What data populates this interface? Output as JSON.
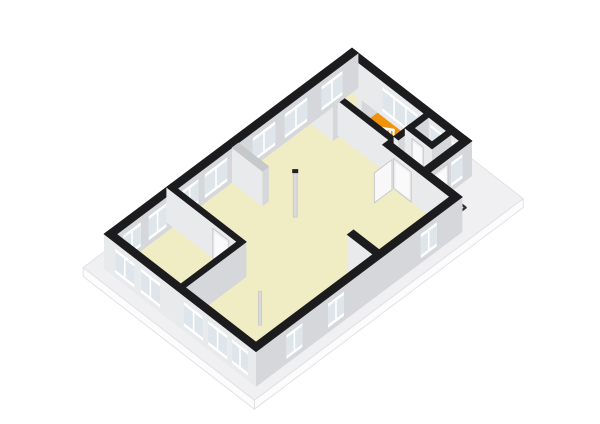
{
  "scene": {
    "description": "3d-isometric-floor-plan",
    "canvas": {
      "w": 600,
      "h": 424,
      "bg": "#ffffff"
    },
    "projection": {
      "origin": [
        352,
        83
      ],
      "axis_x": [
        0.8,
        0.62
      ],
      "axis_y": [
        -0.8,
        0.6
      ],
      "wall_height": 35,
      "slab_thickness": 9
    },
    "palette": {
      "bg": "#ffffff",
      "slab_top": "#f0f0f2",
      "slab_side": "#fcfcfd",
      "slab_edge": "#e2e2e6",
      "floor_cream": "#f0ecc3",
      "floor_orange": "#f0930c",
      "floor_white": "#fbfbfc",
      "wall_top_black": "#1c1c1e",
      "wall_top_gray": "#c7c8ca",
      "face_px": "#d5d7da",
      "face_py": "#e9eaec",
      "face_ny": "#f3f3f4",
      "face_nx": "#f6f6f7",
      "glass": "#dee6eb",
      "frame": "#ffffff",
      "door_frame": "#f1f1f2",
      "door_panel": "#fafafa",
      "door_edge": "#c9c9cc",
      "column": "#d8dadc",
      "column_cap": "#222226",
      "railing": "#ffffff",
      "stair_base": "#f4f4f5",
      "tread": "#cfcfcf",
      "arrow": "#ffffff",
      "arrow_edge": "#b5b5b8",
      "pad_border": "#323234",
      "pad_fill": "#ededef",
      "pad_inner": "#f7f7f8",
      "wc_top": "#fdfdfe",
      "wc_side": "#d9dbdd"
    },
    "slab": {
      "rect": [
        -14,
        -14,
        200,
        322
      ]
    },
    "floors": [
      {
        "id": "floor-living-room",
        "poly": [
          [
            8,
            8
          ],
          [
            142,
            8
          ],
          [
            142,
            52
          ],
          [
            182,
            52
          ],
          [
            182,
            302
          ],
          [
            8,
            302
          ]
        ],
        "color": "cream"
      },
      {
        "id": "floor-stairwell",
        "rect": [
          36,
          8,
          98,
          46
        ],
        "color": "orange"
      },
      {
        "id": "floor-toilet",
        "rect": [
          104,
          8,
          126,
          26
        ],
        "color": "white"
      },
      {
        "id": "floor-closet",
        "rect": [
          132,
          8,
          142,
          26
        ],
        "color": "white"
      },
      {
        "id": "floor-entrance-hall",
        "rect": [
          104,
          32,
          142,
          52
        ],
        "color": "white"
      }
    ],
    "stairs": {
      "strip": [
        48,
        22,
        96,
        44
      ],
      "treads": 10,
      "arrow": [
        [
          93,
          30.5
        ],
        [
          67,
          30.5
        ],
        [
          67,
          25.5
        ],
        [
          56,
          33
        ],
        [
          67,
          40.5
        ],
        [
          67,
          35.5
        ],
        [
          93,
          35.5
        ]
      ]
    },
    "railing": {
      "x1": 50,
      "x2": 96,
      "y": 44,
      "rise": [
        3,
        26
      ],
      "posts": 11,
      "post_h": 13,
      "z": 118
    },
    "pad": {
      "rect": [
        152,
        30,
        172,
        50
      ],
      "inner": [
        155.5,
        33.5,
        168.5,
        46.5
      ]
    },
    "wc": {
      "rect": [
        107,
        11,
        117,
        20
      ],
      "h": 11,
      "z": 141
    },
    "door_panel_open": {
      "a": [
        112,
        62
      ],
      "b": [
        112,
        84
      ],
      "h": 30
    },
    "columns": [
      {
        "id": "column-1",
        "p": [
          75,
          146
        ],
        "h": 44,
        "w": 4,
        "cap": true
      },
      {
        "id": "column-2",
        "p": [
          142,
          257
        ],
        "h": 34,
        "w": 3,
        "cap": false
      }
    ],
    "walls": [
      {
        "id": "wall-exterior-nw",
        "rect": [
          0,
          0,
          8,
          310
        ],
        "top": "black",
        "show_nx": true,
        "openings": [
          {
            "kind": "window",
            "face": "+x",
            "span": [
              20,
              46
            ],
            "mull": 1
          },
          {
            "kind": "window",
            "face": "+x",
            "span": [
              64,
              92
            ],
            "mull": 1
          },
          {
            "kind": "window",
            "face": "+x",
            "span": [
              104,
              132
            ],
            "mull": 1
          },
          {
            "kind": "window",
            "face": "+x",
            "span": [
              164,
              192
            ],
            "mull": 1
          },
          {
            "kind": "window",
            "face": "+x",
            "span": [
              200,
              222
            ],
            "mull": 1
          },
          {
            "kind": "window",
            "face": "+x",
            "span": [
              240,
              262
            ],
            "mull": 1
          },
          {
            "kind": "window",
            "face": "+x",
            "span": [
              272,
              294
            ],
            "mull": 1
          }
        ]
      },
      {
        "id": "wall-exterior-ne",
        "rect": [
          0,
          0,
          150,
          8
        ],
        "top": "black",
        "show_ny": true,
        "openings": [
          {
            "kind": "window",
            "face": "+y",
            "span": [
              46,
              90
            ],
            "mull": 2
          },
          {
            "kind": "window",
            "face": "+y",
            "span": [
              106,
              122
            ],
            "mull": 0
          },
          {
            "kind": "window",
            "face": "+y",
            "span": [
              133,
              141
            ],
            "mull": 0
          }
        ]
      },
      {
        "id": "wall-exterior-east",
        "rect": [
          142,
          0,
          150,
          52
        ],
        "top": "black",
        "show_ny": true,
        "openings": [
          {
            "kind": "window",
            "face": "+x",
            "span": [
              12,
              26
            ],
            "mull": 0
          },
          {
            "kind": "door",
            "face": "+x",
            "span": [
              30,
              48
            ]
          }
        ]
      },
      {
        "id": "wall-exterior-step",
        "rect": [
          142,
          52,
          190,
          60
        ],
        "top": "black",
        "show_ny": true,
        "openings": []
      },
      {
        "id": "wall-exterior-se",
        "rect": [
          182,
          60,
          190,
          310
        ],
        "top": "black",
        "openings": [
          {
            "kind": "window",
            "face": "+x",
            "span": [
              84,
              104
            ],
            "mull": 1
          },
          {
            "kind": "window",
            "face": "+x",
            "span": [
              200,
              220
            ],
            "mull": 1
          },
          {
            "kind": "window",
            "face": "+x",
            "span": [
              252,
              272
            ],
            "mull": 1
          }
        ]
      },
      {
        "id": "wall-exterior-sw",
        "rect": [
          0,
          302,
          190,
          310
        ],
        "top": "black",
        "openings": [
          {
            "kind": "window",
            "face": "+y",
            "span": [
              14,
              38
            ],
            "mull": 1
          },
          {
            "kind": "window",
            "face": "+y",
            "span": [
              46,
              70
            ],
            "mull": 1
          },
          {
            "kind": "window",
            "face": "+y",
            "span": [
              100,
              124
            ],
            "mull": 1
          },
          {
            "kind": "window",
            "face": "+y",
            "span": [
              130,
              154
            ],
            "mull": 1
          },
          {
            "kind": "window",
            "face": "+y",
            "span": [
              160,
              180
            ],
            "mull": 1
          }
        ]
      },
      {
        "id": "wall-stairwell-sw",
        "rect": [
          34,
          8,
          40,
          28
        ],
        "top": "black",
        "openings": []
      },
      {
        "id": "wall-stairwell-se",
        "rect": [
          34,
          46,
          104,
          52
        ],
        "top": "black",
        "openings": []
      },
      {
        "id": "wall-toilet-west",
        "rect": [
          98,
          8,
          104,
          46
        ],
        "top": "black",
        "openings": []
      },
      {
        "id": "wall-toilet-closet",
        "rect": [
          126,
          8,
          132,
          32
        ],
        "top": "black",
        "openings": []
      },
      {
        "id": "wall-toilet-se",
        "rect": [
          98,
          26,
          142,
          32
        ],
        "top": "black",
        "openings": [
          {
            "kind": "door",
            "face": "+y",
            "span": [
              107,
              121
            ]
          },
          {
            "kind": "door",
            "face": "+y",
            "span": [
              133,
              141
            ]
          }
        ]
      },
      {
        "id": "wall-hall-se",
        "rect": [
          98,
          52,
          142,
          60
        ],
        "top": "black",
        "openings": [
          {
            "kind": "door",
            "face": "+y",
            "span": [
              112,
              134
            ]
          }
        ]
      },
      {
        "id": "wall-stub-north",
        "rect": [
          8,
          52,
          36,
          60
        ],
        "top": "black",
        "openings": []
      },
      {
        "id": "wall-stub-middle",
        "rect": [
          8,
          150,
          46,
          158
        ],
        "top": "gray",
        "openings": []
      },
      {
        "id": "wall-stub-se",
        "rect": [
          150,
          148,
          182,
          156
        ],
        "top": "black",
        "openings": []
      },
      {
        "id": "wall-left-room-ne",
        "rect": [
          0,
          226,
          94,
          232
        ],
        "top": "black",
        "openings": [
          {
            "kind": "door",
            "face": "+y",
            "span": [
              58,
              78
            ]
          }
        ]
      },
      {
        "id": "wall-left-room-se",
        "rect": [
          88,
          232,
          94,
          310
        ],
        "top": "black",
        "openings": []
      }
    ]
  }
}
